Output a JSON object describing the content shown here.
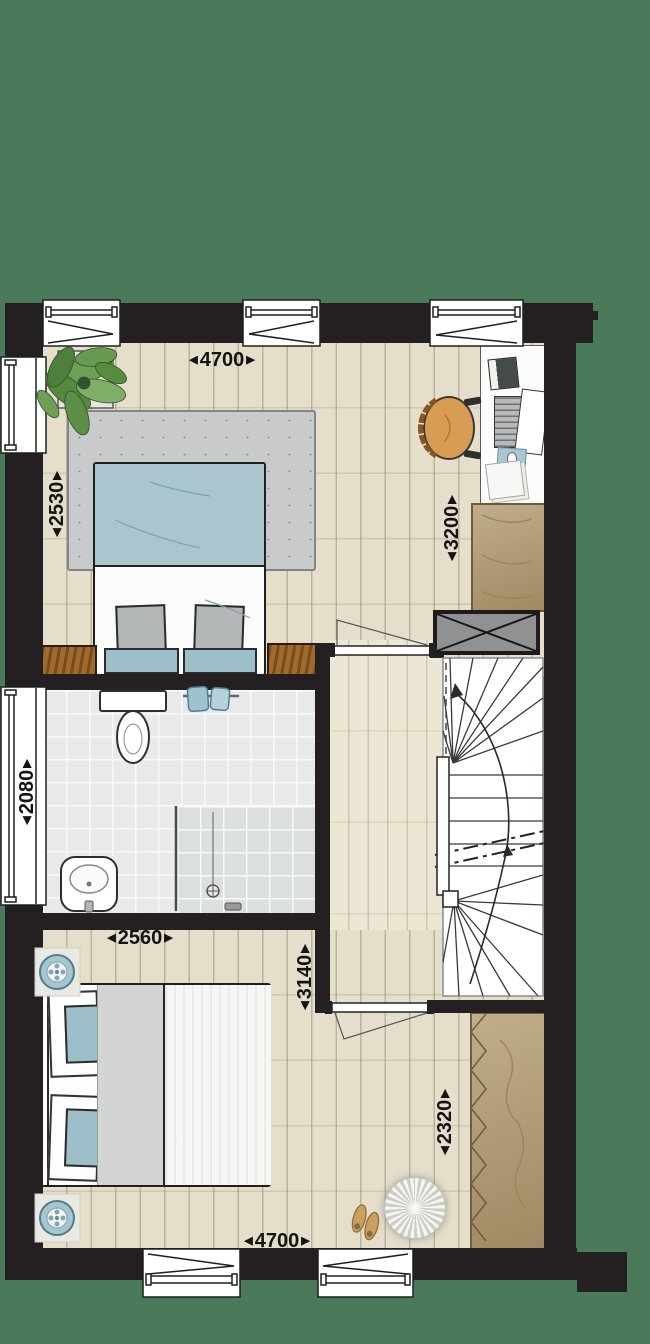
{
  "title": "floor-plan",
  "colors": {
    "background": "#4a7a59",
    "wall": "#242021",
    "wood_floor": "#e4decb",
    "hall_floor": "#ece6d4",
    "tile_floor": "#e7e9ea",
    "rug": "#c9cacb",
    "bed_blue": "#a9c5ce",
    "cushion_blue": "#9dbfc9",
    "cabinet_wood": "#a16b2e",
    "wardrobe_wood": "#b49b72",
    "dimension_text": "#141414"
  },
  "dimensions": {
    "master_width": {
      "left_arrow": "◀",
      "value": "4700",
      "right_arrow": "▶",
      "orientation": "horizontal"
    },
    "master_left_depth": {
      "left_arrow": "◀",
      "value": "2530",
      "right_arrow": "▶",
      "orientation": "vertical"
    },
    "master_right_depth": {
      "left_arrow": "◀",
      "value": "3200",
      "right_arrow": "▶",
      "orientation": "vertical"
    },
    "bathroom_depth": {
      "left_arrow": "◀",
      "value": "2080",
      "right_arrow": "▶",
      "orientation": "vertical"
    },
    "bathroom_width": {
      "left_arrow": "◀",
      "value": "2560",
      "right_arrow": "▶",
      "orientation": "horizontal"
    },
    "bedroom2_depth": {
      "left_arrow": "◀",
      "value": "3140",
      "right_arrow": "▶",
      "orientation": "vertical"
    },
    "bedroom2_right_depth": {
      "left_arrow": "◀",
      "value": "2320",
      "right_arrow": "▶",
      "orientation": "vertical"
    },
    "bedroom2_width": {
      "left_arrow": "◀",
      "value": "4700",
      "right_arrow": "▶",
      "orientation": "horizontal"
    }
  }
}
